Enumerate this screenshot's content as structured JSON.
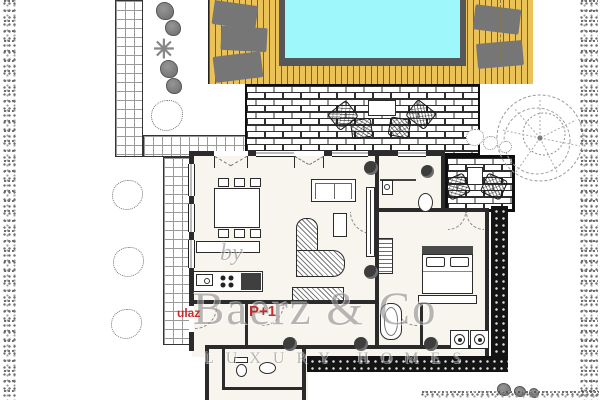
{
  "watermark": {
    "by_text": "by",
    "brand": "Baerz & Co",
    "tagline": "LUXURY HOMES"
  },
  "labels": {
    "entrance": "ulaz",
    "plan_note": "P+1"
  },
  "icons": {
    "plant_star": "✳"
  },
  "colors": {
    "pool_water": "#9ef7fa",
    "pool_frame": "#55575a",
    "deck_wood": "#ebc257",
    "deck_stripe": "#8c6d22",
    "sun_lounger": "#767676",
    "wall": "#2b2b2b",
    "hedge_black": "#141414",
    "hedge_gray": "#8a8a8a",
    "interior_floor": "#f8f5ee",
    "label_red": "#bf1f1f",
    "watermark_gray": "#9a9a9a"
  },
  "plan": {
    "outdoor_features": [
      "swimming pool",
      "wooden sun deck",
      "five sun loungers",
      "brick patio",
      "outdoor dining table with four chairs",
      "side patio with table and two chairs",
      "tiled garden path",
      "side terrace",
      "perimeter hedges",
      "garden shrubs",
      "tree"
    ],
    "indoor_features": [
      "living and dining room",
      "dining table with six chairs",
      "sofa with side table",
      "curved sectional sofa",
      "tv cabinet",
      "kitchen counter with sink and hob",
      "kitchen island",
      "sideboard",
      "bedroom with double bed and wardrobe",
      "bathroom with washbasin and toilet",
      "bathroom with bathtub",
      "laundry with two appliances",
      "guest wc",
      "entrance steps"
    ]
  }
}
